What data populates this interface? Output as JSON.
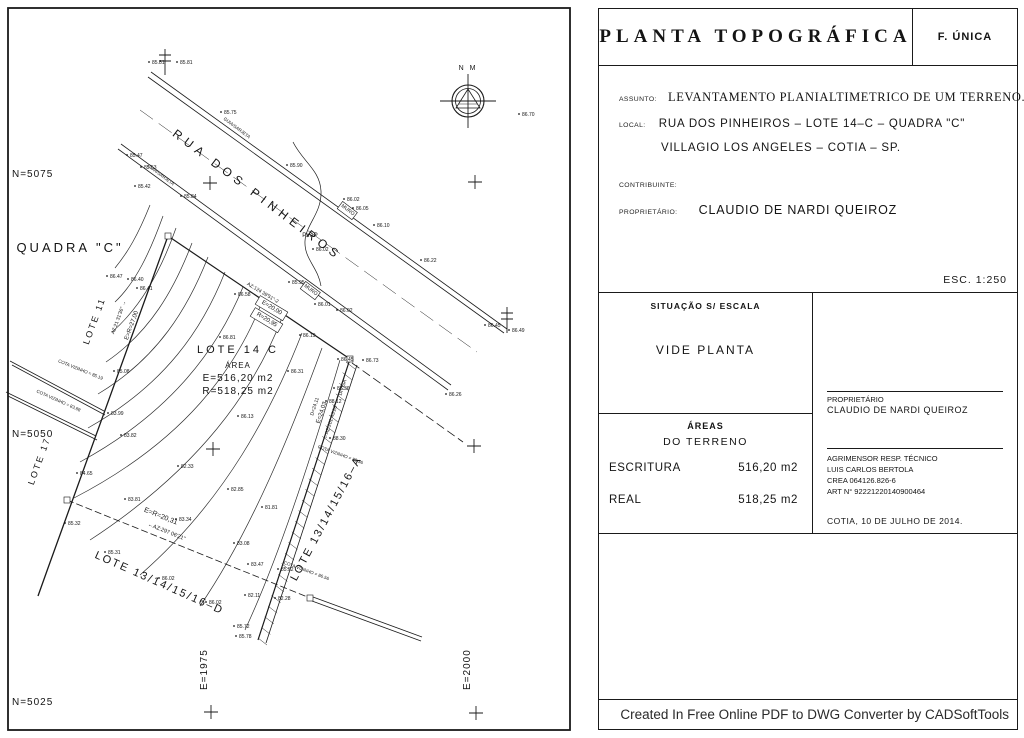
{
  "title_block": {
    "title": "PLANTA TOPOGRÁFICA",
    "sheet": "F. ÚNICA",
    "assunto_label": "ASSUNTO:",
    "assunto": "LEVANTAMENTO PLANIALTIMETRICO DE UM TERRENO.",
    "local_label": "LOCAL:",
    "local_line1": "RUA DOS PINHEIROS – LOTE 14–C – QUADRA \"C\"",
    "local_line2": "VILLAGIO LOS ANGELES – COTIA – SP.",
    "contribuinte_label": "CONTRIBUINTE:",
    "proprietario_label": "PROPRIETÁRIO:",
    "proprietario": "CLAUDIO DE NARDI QUEIROZ",
    "escala": "ESC. 1:250",
    "situacao_header": "SITUAÇÃO S/ ESCALA",
    "situacao_body": "VIDE PLANTA",
    "areas_header": "ÁREAS",
    "areas_sub": "DO TERRENO",
    "escritura_label": "ESCRITURA",
    "escritura_value": "516,20 m2",
    "real_label": "REAL",
    "real_value": "518,25 m2",
    "owner_sign_label": "PROPRIETÁRIO",
    "owner_sign_name": "CLAUDIO DE NARDI QUEIROZ",
    "surveyor_lines": [
      "AGRIMENSOR RESP. TÉCNICO",
      "LUIS CARLOS BERTOLA",
      "CREA 064126.826-6",
      "ART N° 92221220140900464"
    ],
    "date_line": "COTIA, 10 DE JULHO DE 2014.",
    "footer": "Created In Free Online PDF to DWG Converter by CADSoftTools"
  },
  "map": {
    "labels": [
      {
        "t": "RUA DOS PINHEIROS",
        "x": 255,
        "y": 198,
        "rot": 37,
        "s": 12,
        "ls": 5
      },
      {
        "t": "QUADRA \"C\"",
        "x": 70,
        "y": 252,
        "s": 13,
        "ls": 3
      },
      {
        "t": "LOTE 11",
        "x": 97,
        "y": 322,
        "rot": -70,
        "s": 9,
        "ls": 2
      },
      {
        "t": "LOTE 17",
        "x": 42,
        "y": 462,
        "rot": -70,
        "s": 9,
        "ls": 2
      },
      {
        "t": "LOTE 14 C",
        "x": 238,
        "y": 353,
        "s": 11,
        "ls": 3
      },
      {
        "t": "ÁREA",
        "x": 238,
        "y": 368,
        "s": 8,
        "ls": 1
      },
      {
        "t": "E=516,20 m2",
        "x": 238,
        "y": 381,
        "s": 10,
        "ls": 1
      },
      {
        "t": "R=518,25 m2",
        "x": 238,
        "y": 394,
        "s": 10,
        "ls": 1
      },
      {
        "t": "LOTE 13/14/15/16–D",
        "x": 158,
        "y": 586,
        "rot": 24,
        "s": 11,
        "ls": 2
      },
      {
        "t": "LOTE 13/14/15/16–A",
        "x": 329,
        "y": 520,
        "rot": -62,
        "s": 11,
        "ls": 2
      },
      {
        "t": "DIVISA",
        "x": 344,
        "y": 388,
        "rot": -72,
        "s": 5
      },
      {
        "t": "PVAP",
        "x": 310,
        "y": 237,
        "s": 6
      },
      {
        "t": "AZ:21 31'36\" →",
        "x": 120,
        "y": 318,
        "rot": -70,
        "s": 5
      },
      {
        "t": "E=R=27,00",
        "x": 133,
        "y": 326,
        "rot": -70,
        "s": 6
      },
      {
        "t": "AZ:124 39'51\"-2",
        "x": 262,
        "y": 294,
        "rot": 31,
        "s": 5
      },
      {
        "t": "E=20,00",
        "x": 271,
        "y": 309,
        "rot": 31,
        "s": 6,
        "box": true
      },
      {
        "t": "R=20,95",
        "x": 266,
        "y": 321,
        "rot": 31,
        "s": 6,
        "box": true
      },
      {
        "t": "D=24,11",
        "x": 316,
        "y": 407,
        "rot": -72,
        "s": 5
      },
      {
        "t": "E=24,03",
        "x": 323,
        "y": 413,
        "rot": -72,
        "s": 6
      },
      {
        "t": "←AZ:201 43'26\"",
        "x": 332,
        "y": 422,
        "rot": -72,
        "s": 5
      },
      {
        "t": "E=R=20,31",
        "x": 160,
        "y": 518,
        "rot": 22,
        "s": 7
      },
      {
        "t": "←AZ:297 06'21\"",
        "x": 166,
        "y": 533,
        "rot": 22,
        "s": 5.5
      },
      {
        "t": "GUIA/SARJETA",
        "x": 236,
        "y": 129,
        "rot": 37,
        "s": 4.5
      },
      {
        "t": "GUIA/SARJETA",
        "x": 160,
        "y": 176,
        "rot": 37,
        "s": 4.5
      },
      {
        "t": "MURO",
        "x": 347,
        "y": 211,
        "rot": 37,
        "s": 5,
        "box": true
      },
      {
        "t": "MURO",
        "x": 310,
        "y": 291,
        "rot": 37,
        "s": 5,
        "box": true
      },
      {
        "t": "COTA VIZINHO = 85.19",
        "x": 80,
        "y": 371,
        "rot": 22,
        "s": 4.5
      },
      {
        "t": "COTA VIZINHO = 83.88",
        "x": 58,
        "y": 402,
        "rot": 24,
        "s": 4.5
      },
      {
        "t": "COTA VIZINHO = 88.36",
        "x": 340,
        "y": 456,
        "rot": 20,
        "s": 4.5
      },
      {
        "t": "COTA VIZINHO = 86.56",
        "x": 306,
        "y": 572,
        "rot": 20,
        "s": 4.5
      },
      {
        "t": "N M",
        "x": 468,
        "y": 70,
        "s": 7,
        "ls": 2
      },
      {
        "t": "N=5075",
        "x": 12,
        "y": 177,
        "s": 10,
        "ls": 1,
        "a": "start"
      },
      {
        "t": "N=5050",
        "x": 12,
        "y": 437,
        "s": 10,
        "ls": 1,
        "a": "start"
      },
      {
        "t": "N=5025",
        "x": 12,
        "y": 705,
        "s": 10,
        "ls": 1,
        "a": "start"
      },
      {
        "t": "E=1975",
        "x": 207,
        "y": 690,
        "rot": -90,
        "s": 10,
        "ls": 1,
        "a": "start"
      },
      {
        "t": "E=2000",
        "x": 470,
        "y": 690,
        "rot": -90,
        "s": 10,
        "ls": 1,
        "a": "start"
      }
    ],
    "spots": [
      [
        152,
        64,
        "85.81"
      ],
      [
        180,
        64,
        "85.81"
      ],
      [
        224,
        114,
        "85.75"
      ],
      [
        290,
        167,
        "85.90"
      ],
      [
        347,
        201,
        "86.02"
      ],
      [
        356,
        210,
        "86.05"
      ],
      [
        377,
        227,
        "86.10"
      ],
      [
        424,
        262,
        "86.22"
      ],
      [
        522,
        116,
        "86.70"
      ],
      [
        488,
        327,
        "86.45"
      ],
      [
        512,
        332,
        "86.49"
      ],
      [
        130,
        157,
        "85.47"
      ],
      [
        144,
        169,
        "85.53"
      ],
      [
        138,
        188,
        "85.42"
      ],
      [
        184,
        198,
        "85.84"
      ],
      [
        292,
        284,
        "85.95"
      ],
      [
        318,
        306,
        "86.01"
      ],
      [
        340,
        312,
        "86.02"
      ],
      [
        449,
        396,
        "86.26"
      ],
      [
        316,
        251,
        "86.02"
      ],
      [
        110,
        278,
        "86.47"
      ],
      [
        131,
        281,
        "86.40"
      ],
      [
        140,
        290,
        "86.41"
      ],
      [
        117,
        373,
        "85.08"
      ],
      [
        111,
        415,
        "83.99"
      ],
      [
        124,
        437,
        "83.82"
      ],
      [
        181,
        468,
        "82.33"
      ],
      [
        80,
        475,
        "84.65"
      ],
      [
        128,
        501,
        "83.81"
      ],
      [
        68,
        525,
        "85.32"
      ],
      [
        108,
        554,
        "85.31"
      ],
      [
        238,
        296,
        "86.58"
      ],
      [
        223,
        339,
        "86.81"
      ],
      [
        291,
        373,
        "86.31"
      ],
      [
        241,
        418,
        "86.13"
      ],
      [
        303,
        337,
        "86.19"
      ],
      [
        341,
        361,
        "86.45"
      ],
      [
        366,
        362,
        "86.73"
      ],
      [
        337,
        390,
        "87.36"
      ],
      [
        329,
        403,
        "88.12"
      ],
      [
        333,
        440,
        "88.30"
      ],
      [
        231,
        491,
        "82.85"
      ],
      [
        265,
        509,
        "81.81"
      ],
      [
        179,
        521,
        "83.34"
      ],
      [
        237,
        545,
        "83.08"
      ],
      [
        251,
        566,
        "83.47"
      ],
      [
        281,
        571,
        "85.52"
      ],
      [
        162,
        580,
        "86.02"
      ],
      [
        209,
        604,
        "86.02"
      ],
      [
        248,
        597,
        "82.11"
      ],
      [
        278,
        600,
        "82.28"
      ],
      [
        237,
        628,
        "85.72"
      ],
      [
        239,
        638,
        "85.78"
      ]
    ],
    "crosses": [
      [
        210,
        183
      ],
      [
        475,
        182
      ],
      [
        213,
        449
      ],
      [
        474,
        446
      ],
      [
        211,
        712
      ],
      [
        476,
        713
      ]
    ],
    "markers": [
      [
        168,
        236
      ],
      [
        67,
        500
      ],
      [
        350,
        359
      ],
      [
        310,
        598
      ]
    ],
    "monuments": [
      [
        165,
        62
      ],
      [
        507,
        320
      ]
    ],
    "solid": [
      {
        "d": "M148 77 L504 333"
      },
      {
        "d": "M151 72 L507 329"
      },
      {
        "d": "M118 149 L448 390"
      },
      {
        "d": "M121 144 L451 385"
      },
      {
        "d": "M168 236 L350 359",
        "w": 1.2
      },
      {
        "d": "M168 236 L48 568 L38 596",
        "w": 1.3
      },
      {
        "d": "M350 359 L258 640",
        "w": 1.2
      },
      {
        "d": "M357 365 L266 643"
      },
      {
        "d": "M10 361 L104 411"
      },
      {
        "d": "M12 365 L105 415"
      },
      {
        "d": "M6 392 L96 436"
      },
      {
        "d": "M8 396 L97 440"
      },
      {
        "d": "M312 601 L421 641"
      },
      {
        "d": "M313 597 L422 637"
      },
      {
        "d": "M293 142 C303 162 320 170 321 191 C322 213 306 224 305 241 C304 259 318 267 321 286",
        "w": 0.7
      }
    ],
    "dashed": [
      {
        "d": "M67 500 L310 598",
        "da": "7 3"
      },
      {
        "d": "M352 363 L463 442",
        "da": "9 4"
      },
      {
        "d": "M140 110 L477 352",
        "da": "16 7",
        "w": 0.5
      }
    ],
    "contours": [
      "M150 205 C138 235 128 252 115 268",
      "M163 216 C150 252 136 282 115 302",
      "M176 228 C162 268 142 306 112 332",
      "M192 243 C174 290 150 332 106 362",
      "M208 257 C188 308 158 358 98 394",
      "M225 272 C203 328 166 384 88 428",
      "M243 287 C218 348 172 412 80 462",
      "M262 302 C236 368 186 440 74 498",
      "M282 318 C254 390 200 468 90 540",
      "M302 333 C272 410 226 500 140 575",
      "M322 348 C292 430 252 530 200 606",
      "M340 360 C315 445 280 555 245 630"
    ],
    "hatch": {
      "x1": 346,
      "y1": 362,
      "x2": 258,
      "y2": 638,
      "n": 26
    }
  }
}
